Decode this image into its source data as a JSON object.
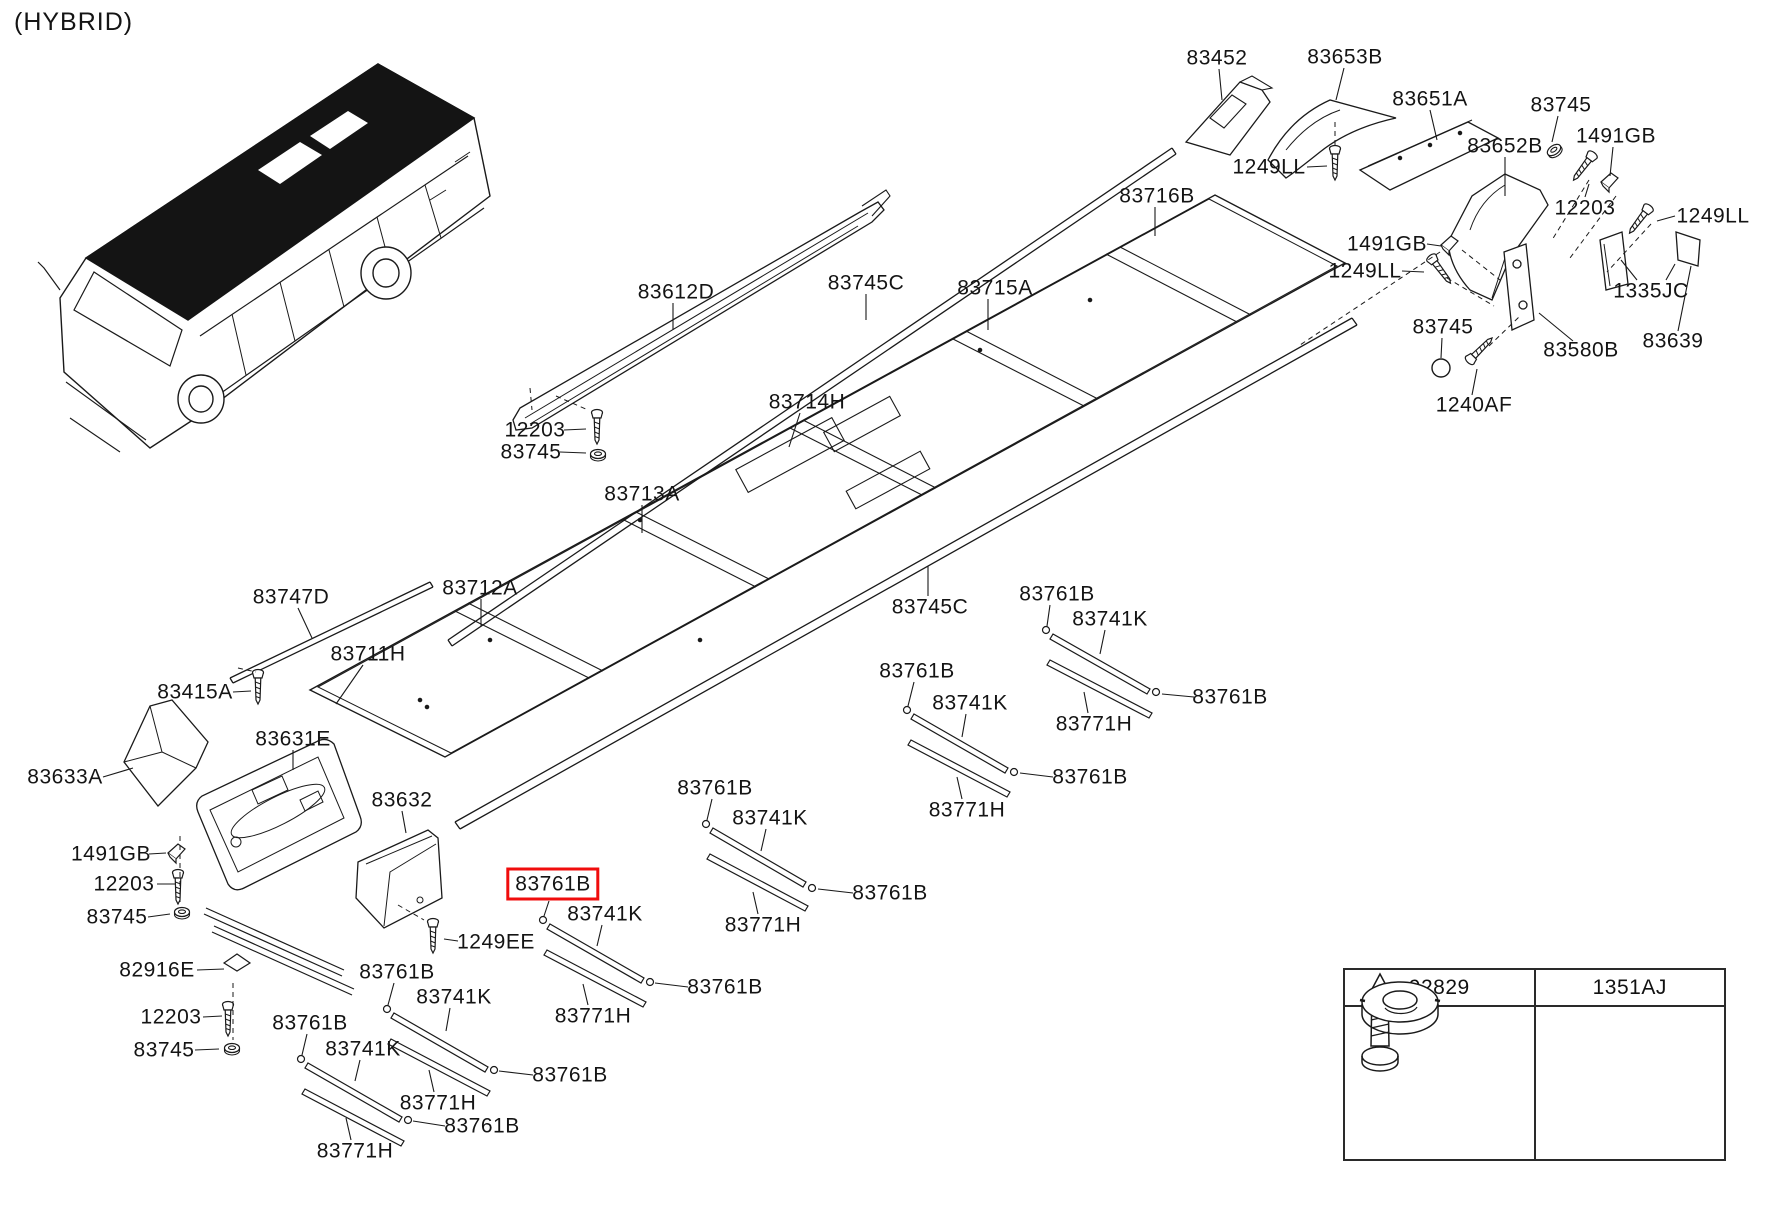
{
  "page": {
    "variant_label": "(HYBRID)"
  },
  "diagram": {
    "highlight_color": "#f00c0c",
    "line_color": "#1a1a1a",
    "selected_part": "83761B",
    "labels": [
      {
        "text": "83452",
        "x": 1217,
        "y": 58
      },
      {
        "text": "83653B",
        "x": 1345,
        "y": 57
      },
      {
        "text": "83651A",
        "x": 1430,
        "y": 99
      },
      {
        "text": "83745",
        "x": 1561,
        "y": 105
      },
      {
        "text": "1491GB",
        "x": 1616,
        "y": 136
      },
      {
        "text": "83652B",
        "x": 1505,
        "y": 146
      },
      {
        "text": "1249LL",
        "x": 1269,
        "y": 167
      },
      {
        "text": "83716B",
        "x": 1157,
        "y": 196
      },
      {
        "text": "12203",
        "x": 1585,
        "y": 208
      },
      {
        "text": "1249LL",
        "x": 1713,
        "y": 216
      },
      {
        "text": "1491GB",
        "x": 1387,
        "y": 244
      },
      {
        "text": "1249LL",
        "x": 1365,
        "y": 271
      },
      {
        "text": "83745C",
        "x": 866,
        "y": 283
      },
      {
        "text": "83715A",
        "x": 995,
        "y": 288
      },
      {
        "text": "83612D",
        "x": 676,
        "y": 292
      },
      {
        "text": "1335JC",
        "x": 1651,
        "y": 291
      },
      {
        "text": "83745",
        "x": 1443,
        "y": 327
      },
      {
        "text": "83639",
        "x": 1673,
        "y": 341
      },
      {
        "text": "83580B",
        "x": 1581,
        "y": 350
      },
      {
        "text": "1240AF",
        "x": 1474,
        "y": 405
      },
      {
        "text": "83714H",
        "x": 807,
        "y": 402
      },
      {
        "text": "12203",
        "x": 535,
        "y": 430
      },
      {
        "text": "83745",
        "x": 531,
        "y": 452
      },
      {
        "text": "83713A",
        "x": 642,
        "y": 494
      },
      {
        "text": "83712A",
        "x": 480,
        "y": 588
      },
      {
        "text": "83747D",
        "x": 291,
        "y": 597
      },
      {
        "text": "83761B",
        "x": 1057,
        "y": 594
      },
      {
        "text": "83745C",
        "x": 930,
        "y": 607
      },
      {
        "text": "83741K",
        "x": 1110,
        "y": 619
      },
      {
        "text": "83711H",
        "x": 368,
        "y": 654
      },
      {
        "text": "83761B",
        "x": 917,
        "y": 671
      },
      {
        "text": "83415A",
        "x": 195,
        "y": 692
      },
      {
        "text": "83761B",
        "x": 1230,
        "y": 697
      },
      {
        "text": "83741K",
        "x": 970,
        "y": 703
      },
      {
        "text": "83771H",
        "x": 1094,
        "y": 724
      },
      {
        "text": "83631E",
        "x": 293,
        "y": 739
      },
      {
        "text": "83633A",
        "x": 65,
        "y": 777
      },
      {
        "text": "83761B",
        "x": 1090,
        "y": 777
      },
      {
        "text": "83761B",
        "x": 715,
        "y": 788
      },
      {
        "text": "83632",
        "x": 402,
        "y": 800
      },
      {
        "text": "83771H",
        "x": 967,
        "y": 810
      },
      {
        "text": "83741K",
        "x": 770,
        "y": 818
      },
      {
        "text": "1491GB",
        "x": 111,
        "y": 854
      },
      {
        "text": "83761B",
        "x": 553,
        "y": 884,
        "boxed": true
      },
      {
        "text": "12203",
        "x": 124,
        "y": 884
      },
      {
        "text": "83761B",
        "x": 890,
        "y": 893
      },
      {
        "text": "83741K",
        "x": 605,
        "y": 914
      },
      {
        "text": "83745",
        "x": 117,
        "y": 917
      },
      {
        "text": "83771H",
        "x": 763,
        "y": 925
      },
      {
        "text": "1249EE",
        "x": 496,
        "y": 942
      },
      {
        "text": "83761B",
        "x": 397,
        "y": 972
      },
      {
        "text": "82916E",
        "x": 157,
        "y": 970
      },
      {
        "text": "83761B",
        "x": 725,
        "y": 987
      },
      {
        "text": "83741K",
        "x": 454,
        "y": 997
      },
      {
        "text": "83771H",
        "x": 593,
        "y": 1016
      },
      {
        "text": "12203",
        "x": 171,
        "y": 1017
      },
      {
        "text": "83761B",
        "x": 310,
        "y": 1023
      },
      {
        "text": "83741K",
        "x": 363,
        "y": 1049
      },
      {
        "text": "83745",
        "x": 164,
        "y": 1050
      },
      {
        "text": "83761B",
        "x": 570,
        "y": 1075
      },
      {
        "text": "83771H",
        "x": 438,
        "y": 1103
      },
      {
        "text": "83761B",
        "x": 482,
        "y": 1126
      },
      {
        "text": "83771H",
        "x": 355,
        "y": 1151
      }
    ]
  },
  "legend_table": {
    "columns": [
      {
        "part_no": "92829",
        "icon": "tapping-screw-icon"
      },
      {
        "part_no": "1351AJ",
        "icon": "grommet-icon"
      }
    ]
  }
}
